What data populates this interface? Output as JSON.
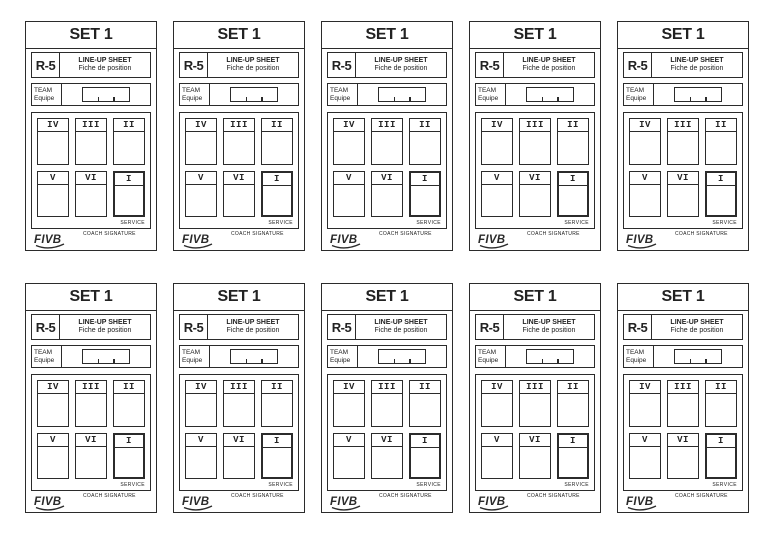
{
  "layout": {
    "rows": 2,
    "cards_per_row": 5,
    "total_cards": 10
  },
  "colors": {
    "ink": "#2b2b2b",
    "paper": "#ffffff"
  },
  "card": {
    "set_title": "SET 1",
    "form_code": "R-5",
    "sheet_title_line1": "LINE-UP SHEET",
    "sheet_title_line2": "Fiche de position",
    "team_label_line1": "TEAM",
    "team_label_line2": "Equipe",
    "positions_top": [
      "IV",
      "III",
      "II"
    ],
    "positions_bottom": [
      "V",
      "VI",
      "I"
    ],
    "service_label": "SERVICE",
    "coach_signature_label": "COACH SIGNATURE",
    "logo_text": "FIVB"
  }
}
